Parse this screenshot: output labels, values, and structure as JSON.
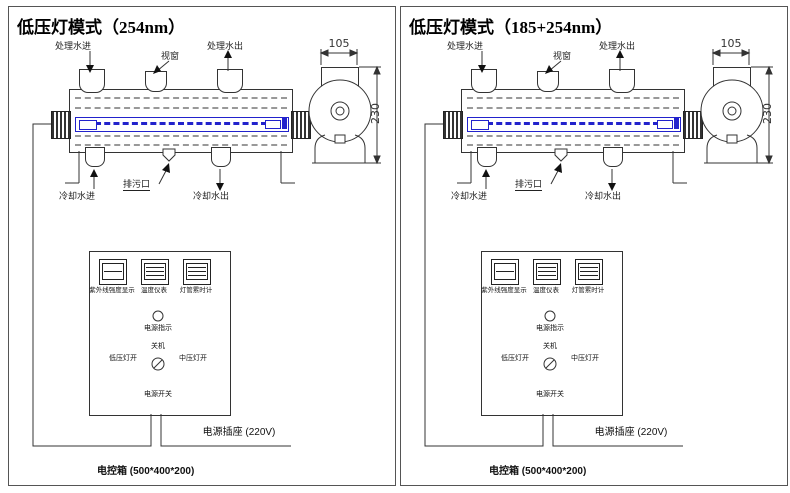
{
  "colors": {
    "lamp": "#2222cc",
    "line": "#333333",
    "dash": "#999999"
  },
  "panels": [
    {
      "title": "低压灯模式（254nm）",
      "chamber": {
        "inlet": "处理水进",
        "window": "视窗",
        "outlet": "处理水出",
        "cooling_in": "冷却水进",
        "drain": "排污口",
        "cooling_out": "冷却水出"
      },
      "side_view": {
        "width": "105",
        "height": "230"
      },
      "control_box": {
        "meters": [
          "紫外线强度显示",
          "温度仪表",
          "灯管累时计"
        ],
        "indicator": "电源指示",
        "off": "关机",
        "low": "低压灯开",
        "mid": "中压灯开",
        "power": "电源开关"
      },
      "socket": "电源插座 (220V)",
      "box": "电控箱 (500*400*200)"
    },
    {
      "title": "低压灯模式（185+254nm）",
      "chamber": {
        "inlet": "处理水进",
        "window": "视窗",
        "outlet": "处理水出",
        "cooling_in": "冷却水进",
        "drain": "排污口",
        "cooling_out": "冷却水出"
      },
      "side_view": {
        "width": "105",
        "height": "230"
      },
      "control_box": {
        "meters": [
          "紫外线强度显示",
          "温度仪表",
          "灯管累时计"
        ],
        "indicator": "电源指示",
        "off": "关机",
        "low": "低压灯开",
        "mid": "中压灯开",
        "power": "电源开关"
      },
      "socket": "电源插座 (220V)",
      "box": "电控箱 (500*400*200)"
    }
  ]
}
